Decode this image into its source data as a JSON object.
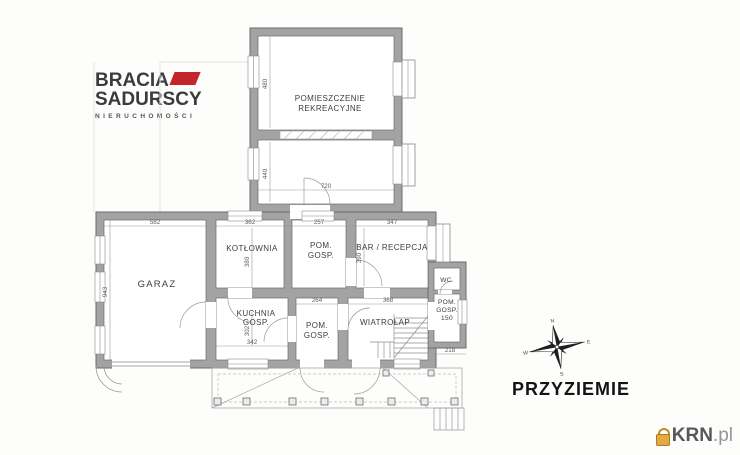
{
  "brand_logo": {
    "word1": "BRACIA",
    "word2": "SADURSCY",
    "tagline": "NIERUCHOMOŚCI"
  },
  "floor_plan": {
    "title": "PRZYZIEMIE",
    "rooms": {
      "pomieszczenie_rekreacyjne": {
        "line1": "POMIESZCZENIE",
        "line2": "REKREACYJNE"
      },
      "garaz": {
        "line1": "GARAZ"
      },
      "kotlownia": {
        "line1": "KOTŁOWNIA"
      },
      "pom_gosp_upper": {
        "line1": "POM.",
        "line2": "GOSP."
      },
      "bar_recepcja": {
        "line1": "BAR / RECEPCJA"
      },
      "kuchnia_gosp": {
        "line1": "KUCHNIA",
        "line2": "GOSP."
      },
      "pom_gosp_lower": {
        "line1": "POM.",
        "line2": "GOSP."
      },
      "wiatrolap": {
        "line1": "WIATROŁAP"
      },
      "wc": {
        "line1": "WC"
      },
      "pom_gosp_entry": {
        "line1": "POM.",
        "line2": "GOSP.",
        "line3": "150"
      }
    },
    "dimensions": {
      "rek_upper_h": "480",
      "rek_lower_h": "440",
      "rek_w": "720",
      "garaz_w": "582",
      "garaz_h": "943",
      "kotlownia_w": "362",
      "kotlownia_h": "380",
      "pom_gosp_upper_w": "257",
      "bar_w": "347",
      "bar_h": "390",
      "kuchnia_w": "342",
      "kuchnia_h": "302",
      "pom_gosp_lower_w": "264",
      "wiatrolap_w": "368",
      "entry_depth": "218"
    },
    "compass_letters": {
      "n": "N",
      "e": "E",
      "s": "S",
      "w": "W"
    }
  },
  "watermark": {
    "brand": "KRN",
    "suffix": ".pl"
  },
  "colors": {
    "wall_fill": "#a3a3a3",
    "wall_edge": "#6b6b6b",
    "thin_line": "#9a9a9a",
    "accent_red": "#c4242b",
    "watermark_orange": "#e3aa3f",
    "title_black": "#141414"
  }
}
